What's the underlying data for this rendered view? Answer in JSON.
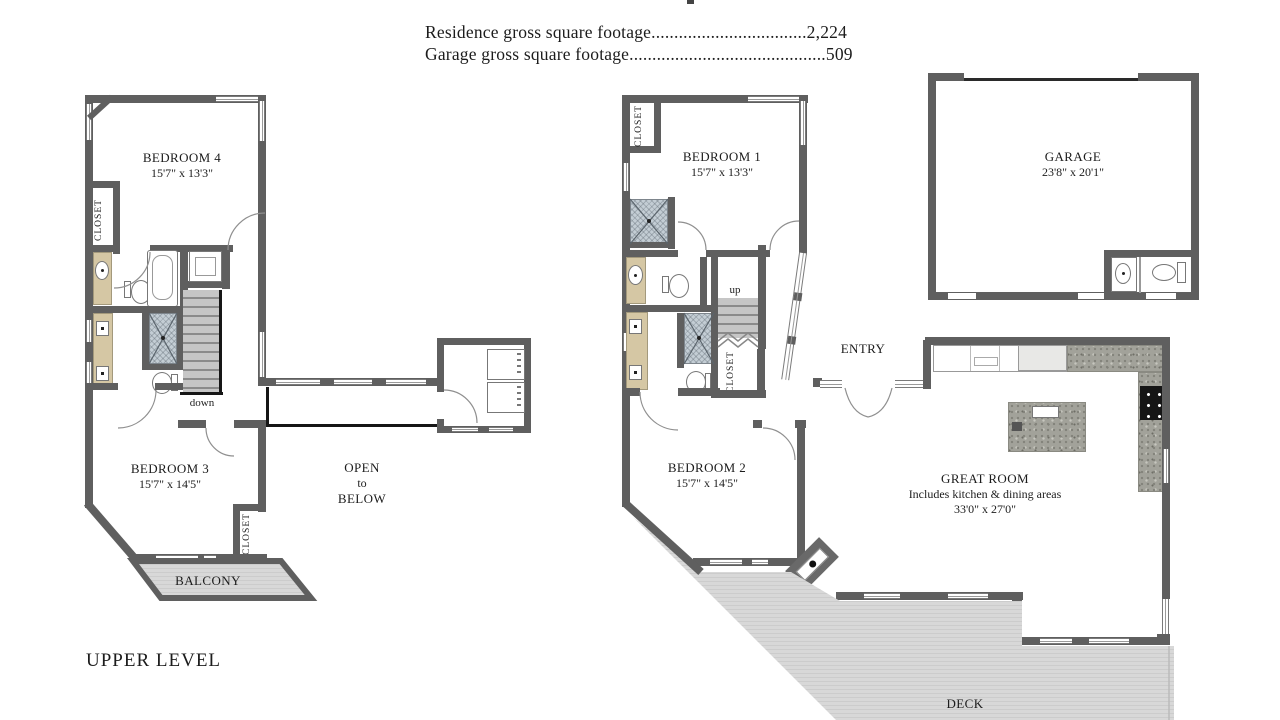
{
  "header": {
    "residence_line": "Residence gross square footage..................................2,224",
    "garage_line": "Garage gross square footage...........................................509"
  },
  "upper_level": {
    "title": "UPPER LEVEL",
    "bedroom4": {
      "name": "BEDROOM 4",
      "dims": "15'7\" x 13'3\""
    },
    "bedroom3": {
      "name": "BEDROOM 3",
      "dims": "15'7\" x 14'5\""
    },
    "closet_bedroom4": "CLOSET",
    "closet_bedroom3": "CLOSET",
    "stairs_label": "down",
    "open_to_below": {
      "line1": "OPEN",
      "line2": "to",
      "line3": "BELOW"
    },
    "balcony": "BALCONY"
  },
  "main_level": {
    "bedroom1": {
      "name": "BEDROOM 1",
      "dims": "15'7\" x 13'3\""
    },
    "bedroom2": {
      "name": "BEDROOM 2",
      "dims": "15'7\" x 14'5\""
    },
    "garage": {
      "name": "GARAGE",
      "dims": "23'8\" x 20'1\""
    },
    "great_room": {
      "name": "GREAT ROOM",
      "subtitle": "Includes kitchen & dining areas",
      "dims": "33'0\" x 27'0\""
    },
    "entry": "ENTRY",
    "deck": "DECK",
    "closet_bedroom1": "CLOSET",
    "closet_hall": "CLOSET",
    "stairs_label": "up"
  },
  "colors": {
    "wall": "#5f5f5f",
    "vanity": "#d5c7a4",
    "shower": "#c3cdd4",
    "deck": "#d8d8d8",
    "granite": "#a2a29a"
  }
}
